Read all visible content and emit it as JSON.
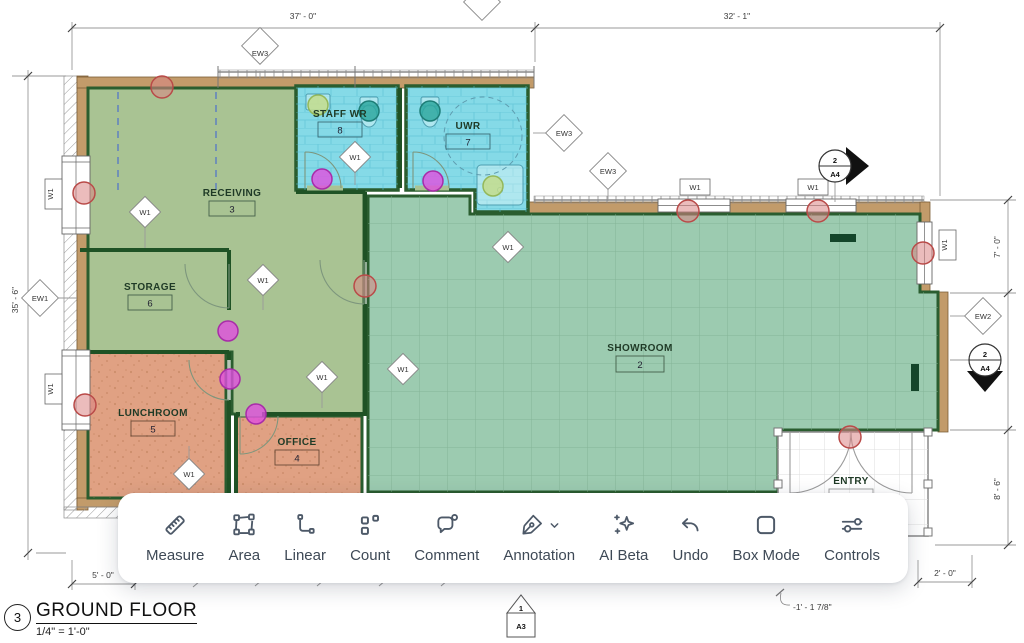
{
  "sheet": {
    "marker_number": "3",
    "title": "GROUND FLOOR",
    "scale": "1/4\" = 1'-0\""
  },
  "rooms": {
    "receiving": {
      "name": "RECEIVING",
      "number": "3"
    },
    "storage": {
      "name": "STORAGE",
      "number": "6"
    },
    "lunchroom": {
      "name": "LUNCHROOM",
      "number": "5"
    },
    "office": {
      "name": "OFFICE",
      "number": "4"
    },
    "showroom": {
      "name": "SHOWROOM",
      "number": "2"
    },
    "staff_wr": {
      "name": "STAFF WR",
      "number": "8"
    },
    "uwr": {
      "name": "UWR",
      "number": "7"
    },
    "entry": {
      "name": "ENTRY"
    }
  },
  "dimensions": {
    "top_left": "37' - 0\"",
    "top_right": "32' - 1\"",
    "left": "35' - 6\"",
    "right_upper": "7' - 0\"",
    "right_mid": "12' - 0\"",
    "right_lower": "8' - 6\"",
    "bottom_left": "5' - 0\"",
    "bottom_right": "2' - 0\"",
    "entry_offset": "-1' - 1 7/8\""
  },
  "tags": {
    "w1": "W1",
    "ew1": "EW1",
    "ew2": "EW2",
    "ew3": "EW3"
  },
  "markers": {
    "section_right": {
      "num": "2",
      "sheet": "A4"
    },
    "section_down": {
      "num": "2",
      "sheet": "A4"
    },
    "elevation": {
      "num": "1",
      "sheet": "A3"
    }
  },
  "toolbar": {
    "items": [
      {
        "label": "Measure",
        "icon": "ruler-icon"
      },
      {
        "label": "Area",
        "icon": "area-polygon-icon"
      },
      {
        "label": "Linear",
        "icon": "polyline-icon"
      },
      {
        "label": "Count",
        "icon": "count-squares-icon"
      },
      {
        "label": "Comment",
        "icon": "comment-bubble-icon"
      },
      {
        "label": "Annotation",
        "icon": "pen-icon"
      },
      {
        "label": "AI Beta",
        "icon": "sparkles-icon"
      },
      {
        "label": "Undo",
        "icon": "undo-arrow-icon"
      },
      {
        "label": "Box Mode",
        "icon": "box-icon"
      },
      {
        "label": "Controls",
        "icon": "sliders-icon"
      }
    ]
  },
  "colors": {
    "room_green": "#a9c393",
    "room_teal": "#9ccbb0",
    "room_salmon": "#e0a183",
    "room_cyan": "#85dae7",
    "wall_tan": "#c29b6a",
    "wall_green": "#2a5d2f",
    "dot_red": "#c0504d",
    "dot_magenta": "#d63fd6",
    "dot_teal": "#2fa8a0",
    "dot_green": "#a4c86a",
    "toolbar_icon": "#4d5968"
  }
}
